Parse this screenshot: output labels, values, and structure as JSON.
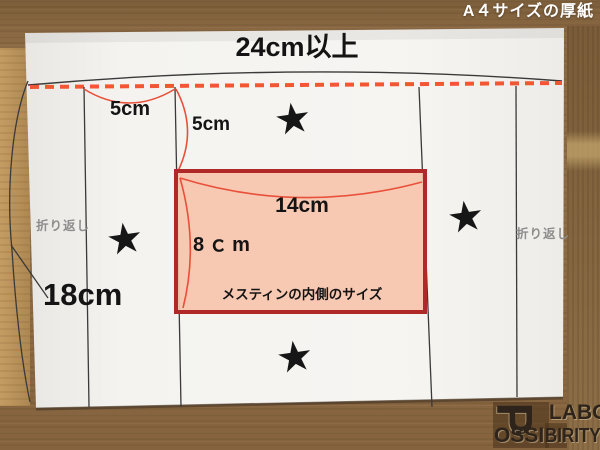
{
  "header": {
    "caption": "A４サイズの厚紙"
  },
  "paper": {
    "top_width_label": "24cm以上",
    "left_height_label": "18cm",
    "fold_tab_width_label": "5cm",
    "fold_tab_height_label": "5cm",
    "fold_note_left": "折り返し",
    "fold_note_right": "折り返し",
    "star_mark": "★"
  },
  "inner_box": {
    "width_label": "14cm",
    "height_label": "8ｃm",
    "caption": "メスティンの内側のサイズ",
    "fill_color": "#f6c3ac",
    "border_color": "#b02828"
  },
  "annotation_colors": {
    "dashed_fold_line": "#f25633",
    "guide_line": "#3a3a3a",
    "measure_arc": "#e8503a"
  },
  "watermark": {
    "letter_p": "P",
    "part_ossi": "OSSI",
    "part_birity": "BIRITY",
    "part_labo": "LABO"
  }
}
